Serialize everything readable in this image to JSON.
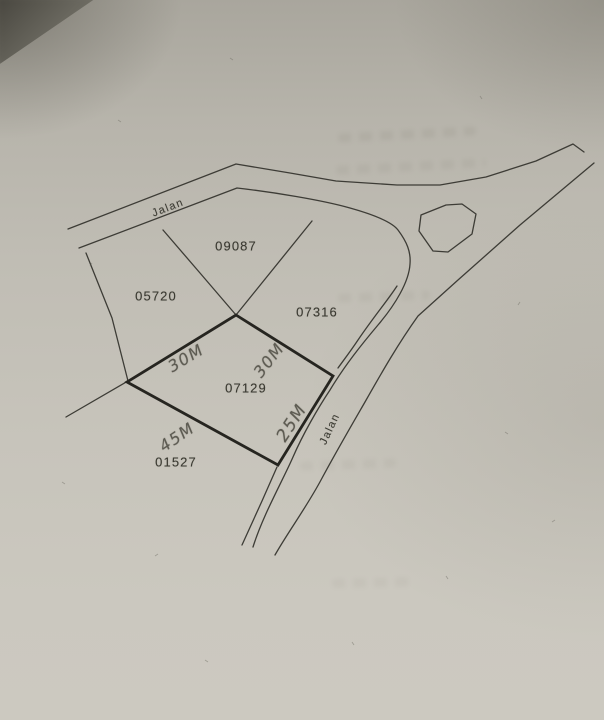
{
  "map": {
    "road_labels": {
      "upper": "Jalan",
      "side": "Jalan"
    },
    "parcels": {
      "p09087": "09087",
      "p05720": "05720",
      "p07316": "07316",
      "p07129": "07129",
      "p01527": "01527"
    },
    "measurements": {
      "northwest": "30M",
      "northeast": "30M",
      "southwest": "45M",
      "southeast": "25M"
    },
    "colors": {
      "paper": "#c3c0b7",
      "ink": "#3d3c36",
      "bold_outline": "#262520",
      "pencil": "#5d5b52"
    }
  }
}
